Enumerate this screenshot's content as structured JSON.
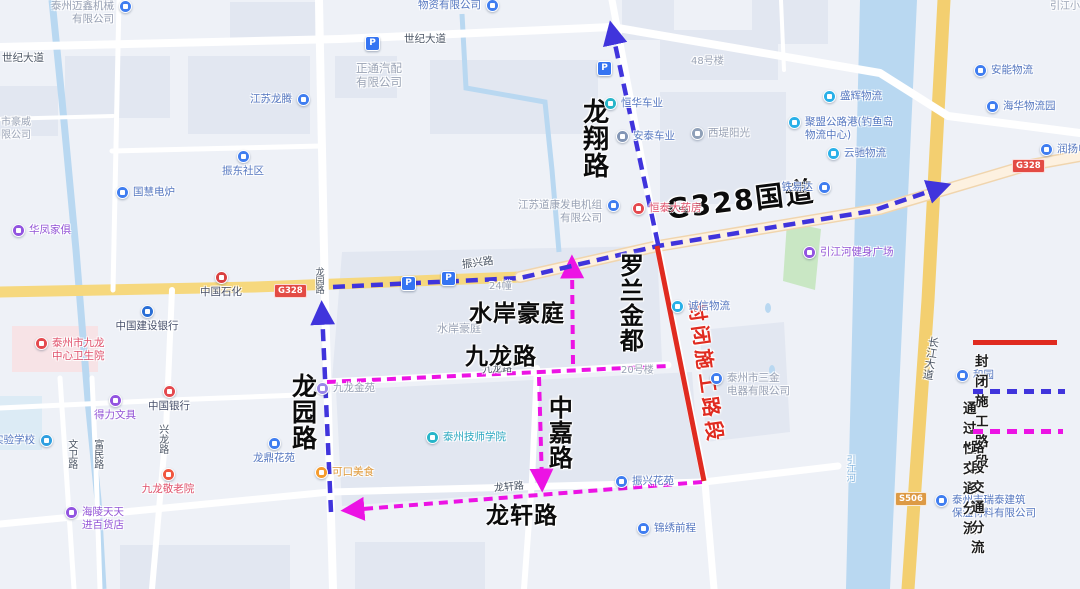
{
  "colors": {
    "closed": "#e02b20",
    "through": "#4034dc",
    "section": "#ec13e4",
    "water": "#b9d8f1",
    "park": "#c9e7c4",
    "road_yellow": "#f6d87e",
    "poi_blue": "#3f7df0",
    "poi_purple": "#9254e0",
    "text_blue": "#5577c0",
    "text_purple": "#9354d6",
    "text_red": "#e0506a",
    "text_gray": "#97a0b3",
    "text_dark": "#47506b",
    "text_teal": "#2ba8c0",
    "text_orange": "#e09a3a"
  },
  "legend": {
    "closed_label": "封闭施工路段",
    "through_label": "通过性交通分流",
    "section_label": "路段交通分流"
  },
  "parking_glyph": "P",
  "badges": [
    {
      "text": "G328",
      "x": 274,
      "y": 284,
      "c": "#e34b44"
    },
    {
      "text": "G328",
      "x": 1012,
      "y": 159,
      "c": "#e34b44"
    },
    {
      "text": "S506",
      "x": 895,
      "y": 492,
      "c": "#dd9a45"
    }
  ],
  "parking": [
    {
      "x": 371,
      "y": 42
    },
    {
      "x": 603,
      "y": 67
    },
    {
      "x": 407,
      "y": 282
    },
    {
      "x": 447,
      "y": 277
    }
  ],
  "labels": [
    {
      "text": "世纪大道",
      "x": 2,
      "y": 52,
      "cls": "rl",
      "name": "road-label-shiji-west"
    },
    {
      "text": "世纪大道",
      "x": 404,
      "y": 33,
      "cls": "rl",
      "name": "road-label-shiji"
    },
    {
      "text": "振兴路",
      "x": 462,
      "y": 257,
      "cls": "rl",
      "rot": -8,
      "name": "road-label-zhenxing"
    },
    {
      "text": "龙园路",
      "x": 313,
      "y": 267,
      "cls": "rl",
      "vert": 1,
      "size": 9,
      "name": "road-label-longyuan-small"
    },
    {
      "text": "兴龙路",
      "x": 156,
      "y": 424,
      "cls": "rl",
      "vert": 1,
      "size": 10,
      "name": "road-label-xinglong"
    },
    {
      "text": "文卫路",
      "x": 65,
      "y": 439,
      "cls": "rl",
      "vert": 1,
      "size": 10,
      "name": "road-label-wenwei"
    },
    {
      "text": "富民路",
      "x": 91,
      "y": 439,
      "cls": "rl",
      "vert": 1,
      "size": 10,
      "name": "road-label-fumin"
    },
    {
      "text": "九龙路",
      "x": 482,
      "y": 364,
      "cls": "rl",
      "rot": -3,
      "size": 10,
      "name": "road-label-jiulong-small"
    },
    {
      "text": "龙轩路",
      "x": 494,
      "y": 482,
      "cls": "rl",
      "rot": -5,
      "size": 10,
      "name": "road-label-longxuan-small"
    },
    {
      "text": "长江大道",
      "x": 923,
      "y": 336,
      "cls": "rl",
      "vert": 1,
      "rot": 9,
      "size": 11,
      "name": "road-label-changjiang"
    },
    {
      "text": "引江河",
      "x": 844,
      "y": 455,
      "cls": "rl",
      "vert": 1,
      "size": 9,
      "color": "#7fb2dd",
      "name": "river-label-yinjiang"
    },
    {
      "text": "24幢",
      "x": 489,
      "y": 281,
      "cls": "gl",
      "name": "building-number-24"
    },
    {
      "text": "20号楼",
      "x": 621,
      "y": 365,
      "cls": "gl",
      "name": "building-number-20"
    },
    {
      "text": "48号楼",
      "x": 691,
      "y": 56,
      "cls": "gl",
      "name": "building-number-48"
    },
    {
      "text": "水岸豪庭",
      "x": 437,
      "y": 323,
      "cls": "gl",
      "size": 11,
      "name": "estate-label-small"
    },
    {
      "text": "正通汽配\n有限公司",
      "x": 356,
      "y": 62,
      "cls": "gl",
      "size": 11.5,
      "name": "poi-label-zhengtong"
    },
    {
      "text": "市豪威",
      "x": 1,
      "y": 117,
      "cls": "gl",
      "name": "poi-label-haowei-partial"
    },
    {
      "text": "限公司",
      "x": 1,
      "y": 130,
      "cls": "gl",
      "name": "poi-label-haowei-partial2"
    },
    {
      "text": "引江小区",
      "x": 1050,
      "y": 1,
      "cls": "gl",
      "name": "poi-label-yinjiang-xiaoqu"
    },
    {
      "text": "龙翔路",
      "x": 578,
      "y": 98,
      "cls": "bl",
      "vert": 1,
      "size": 26,
      "name": "big-label-longxiang-road"
    },
    {
      "text": "罗兰金都",
      "x": 615,
      "y": 253,
      "cls": "bl",
      "vert": 1,
      "size": 24,
      "name": "big-label-luolanjindu"
    },
    {
      "text": "水岸豪庭",
      "x": 469,
      "y": 301,
      "cls": "bl",
      "size": 23,
      "name": "big-label-shuianhaoting"
    },
    {
      "text": "九龙路",
      "x": 465,
      "y": 344,
      "cls": "bl",
      "size": 23,
      "name": "big-label-jiulong-road"
    },
    {
      "text": "中嘉路",
      "x": 544,
      "y": 395,
      "cls": "bl",
      "vert": 1,
      "size": 24,
      "name": "big-label-zhongjia-road"
    },
    {
      "text": "龙轩路",
      "x": 486,
      "y": 503,
      "cls": "bl",
      "size": 23,
      "name": "big-label-longxuan-road"
    },
    {
      "text": "龙园路",
      "x": 288,
      "y": 373,
      "cls": "bl",
      "vert": 1,
      "size": 25,
      "name": "big-label-longyuan-road"
    },
    {
      "text": "G328国道",
      "x": 666,
      "y": 184,
      "cls": "bl g328",
      "size": 28,
      "rot": -7,
      "name": "big-label-g328-national-road"
    },
    {
      "text": "封闭施工路段",
      "x": 707,
      "y": 300,
      "cls": "bl closed-t",
      "size": 20,
      "rot": 82,
      "color": "#e02b20",
      "name": "closed-road-annotation"
    }
  ],
  "pois": [
    {
      "t": "泰州迈鑫机械\n有限公司",
      "x": 125,
      "y": 6,
      "s": "l",
      "ic": "#3f7df0",
      "tc": "gray"
    },
    {
      "t": "物资有限公司",
      "x": 492,
      "y": 5,
      "s": "l",
      "ic": "#3f7df0",
      "tc": "blue"
    },
    {
      "t": "江苏龙腾",
      "x": 303,
      "y": 99,
      "s": "l",
      "ic": "#3f7df0",
      "tc": "blue"
    },
    {
      "t": "振东社区",
      "x": 243,
      "y": 156,
      "s": "b",
      "ic": "#3f7df0",
      "tc": "blue"
    },
    {
      "t": "国慧电炉",
      "x": 122,
      "y": 192,
      "s": "r",
      "ic": "#3f7df0",
      "tc": "blue"
    },
    {
      "t": "华凤家俱",
      "x": 18,
      "y": 230,
      "s": "r",
      "ic": "#9254e0",
      "tc": "purple"
    },
    {
      "t": "中国石化",
      "x": 221,
      "y": 277,
      "s": "b",
      "ic": "#d94040",
      "tc": "dark"
    },
    {
      "t": "中国建设银行",
      "x": 147,
      "y": 311,
      "s": "b",
      "ic": "#2a6fd6",
      "tc": "dark"
    },
    {
      "t": "泰州市九龙\n中心卫生院",
      "x": 41,
      "y": 343,
      "s": "r",
      "ic": "#e4494e",
      "tc": "red"
    },
    {
      "t": "得力文具",
      "x": 115,
      "y": 400,
      "s": "b",
      "ic": "#9254e0",
      "tc": "purple"
    },
    {
      "t": "中国银行",
      "x": 169,
      "y": 391,
      "s": "b",
      "ic": "#e4494e",
      "tc": "dark"
    },
    {
      "t": "实验学校",
      "x": 46,
      "y": 440,
      "s": "l",
      "ic": "#2f9fe0",
      "tc": "blue"
    },
    {
      "t": "龙鼎花苑",
      "x": 274,
      "y": 443,
      "s": "b",
      "ic": "#3f7df0",
      "tc": "blue"
    },
    {
      "t": "九龙敬老院",
      "x": 168,
      "y": 474,
      "s": "b",
      "ic": "#f0563e",
      "tc": "red"
    },
    {
      "t": "海陵天天\n进百货店",
      "x": 71,
      "y": 512,
      "s": "r",
      "ic": "#9254e0",
      "tc": "purple"
    },
    {
      "t": "可口美食",
      "x": 321,
      "y": 472,
      "s": "r",
      "ic": "#f59b2c",
      "tc": "orange"
    },
    {
      "t": "九龙金苑",
      "x": 322,
      "y": 388,
      "s": "r",
      "ic": "#9a86e8",
      "tc": "gray"
    },
    {
      "t": "泰州技师学院",
      "x": 432,
      "y": 437,
      "s": "r",
      "ic": "#27b5c9",
      "tc": "teal"
    },
    {
      "t": "恒华车业",
      "x": 610,
      "y": 103,
      "s": "r",
      "ic": "#27b5c9",
      "tc": "blue"
    },
    {
      "t": "安泰车业",
      "x": 622,
      "y": 136,
      "s": "r",
      "ic": "#8295b5",
      "tc": "blue"
    },
    {
      "t": "西堤阳光",
      "x": 697,
      "y": 133,
      "s": "r",
      "ic": "#8fa0b8",
      "tc": "gray"
    },
    {
      "t": "江苏道康发电机组\n有限公司",
      "x": 613,
      "y": 205,
      "s": "l",
      "ic": "#3f7df0",
      "tc": "gray"
    },
    {
      "t": "恒泰大药房",
      "x": 638,
      "y": 208,
      "s": "r",
      "ic": "#e4494e",
      "tc": "red"
    },
    {
      "t": "铁易达",
      "x": 824,
      "y": 187,
      "s": "l",
      "ic": "#3f7df0",
      "tc": "blue"
    },
    {
      "t": "盛辉物流",
      "x": 829,
      "y": 96,
      "s": "r",
      "ic": "#29b0e8",
      "tc": "blue"
    },
    {
      "t": "聚盟公路港(钓鱼岛\n物流中心)",
      "x": 794,
      "y": 122,
      "s": "r",
      "ic": "#29b0e8",
      "tc": "blue"
    },
    {
      "t": "云驰物流",
      "x": 833,
      "y": 153,
      "s": "r",
      "ic": "#29b0e8",
      "tc": "blue"
    },
    {
      "t": "安能物流",
      "x": 980,
      "y": 70,
      "s": "r",
      "ic": "#3f7df0",
      "tc": "blue"
    },
    {
      "t": "海华物流园",
      "x": 992,
      "y": 106,
      "s": "r",
      "ic": "#3f7df0",
      "tc": "blue"
    },
    {
      "t": "润扬电",
      "x": 1046,
      "y": 149,
      "s": "r",
      "ic": "#3f7df0",
      "tc": "blue"
    },
    {
      "t": "引江河健身广场",
      "x": 809,
      "y": 252,
      "s": "r",
      "ic": "#9254e0",
      "tc": "purple"
    },
    {
      "t": "诚信物流",
      "x": 677,
      "y": 306,
      "s": "r",
      "ic": "#29b0e8",
      "tc": "blue"
    },
    {
      "t": "泰州市三金\n电器有限公司",
      "x": 716,
      "y": 378,
      "s": "r",
      "ic": "#3f7df0",
      "tc": "gray"
    },
    {
      "t": "振兴花苑",
      "x": 621,
      "y": 481,
      "s": "r",
      "ic": "#3f7df0",
      "tc": "blue"
    },
    {
      "t": "锦绣前程",
      "x": 643,
      "y": 528,
      "s": "r",
      "ic": "#3f7df0",
      "tc": "blue"
    },
    {
      "t": "和园",
      "x": 962,
      "y": 375,
      "s": "r",
      "ic": "#3f7df0",
      "tc": "blue"
    },
    {
      "t": "泰州市瑞泰建筑\n保温材料有限公司",
      "x": 941,
      "y": 500,
      "s": "r",
      "ic": "#3f7df0",
      "tc": "blue"
    }
  ]
}
